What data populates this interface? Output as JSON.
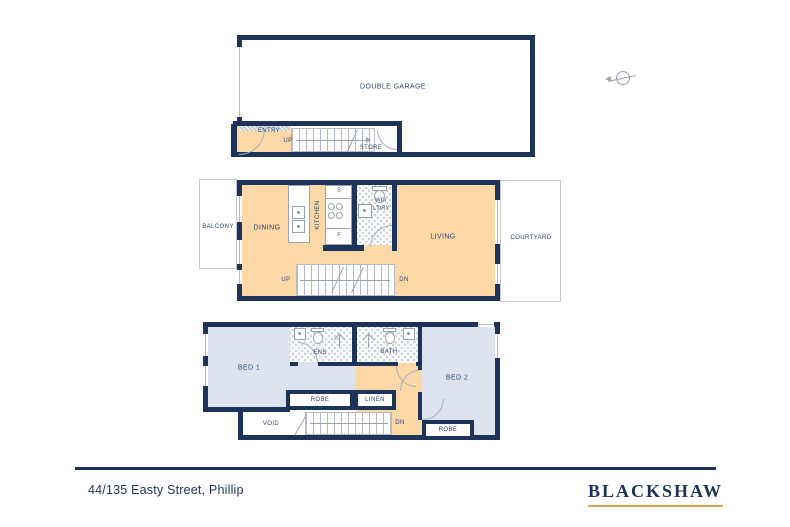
{
  "colors": {
    "wall_navy": "#1e3359",
    "floor_orange": "#fbd8a6",
    "bedroom_blue": "#dce3ef",
    "brand_gold": "#d9a653"
  },
  "icons": [
    "compass-icon",
    "shower-icon",
    "toilet-icon",
    "basin-icon",
    "sink-icon",
    "cooktop-icon",
    "washer-icon"
  ],
  "plans": {
    "garage_level": {
      "rooms": {
        "double_garage": "DOUBLE GARAGE",
        "entry": "ENTRY",
        "store": "STORE"
      },
      "stairs_up": "UP"
    },
    "living_level": {
      "rooms": {
        "balcony": "BALCONY",
        "dining": "DINING",
        "kitchen": "KITCHEN",
        "wc_laundry_line1": "WC/",
        "wc_laundry_line2": "L'DRY",
        "living": "LIVING",
        "courtyard": "COURTYARD"
      },
      "appliances": {
        "sink": "S",
        "fridge": "F"
      },
      "stairs_up": "UP",
      "stairs_down": "DN"
    },
    "bedroom_level": {
      "rooms": {
        "bed1": "BED 1",
        "ensuite": "ENS",
        "bathroom": "BATH",
        "bed2": "BED 2",
        "robe1": "ROBE",
        "linen": "LINEN",
        "void": "VOID",
        "robe2": "ROBE"
      },
      "stairs_down": "DN"
    }
  },
  "footer": {
    "address": "44/135 Easty Street, Phillip",
    "brand": "BLACKSHAW"
  }
}
